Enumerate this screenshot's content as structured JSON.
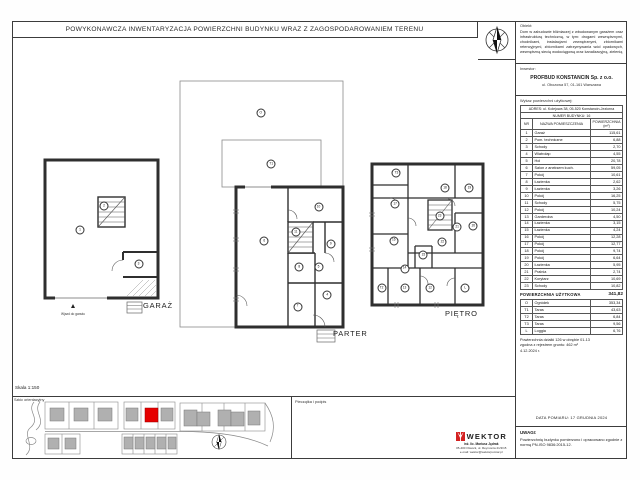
{
  "title": "POWYKONAWCZA INWENTARYZACJA POWIERZCHNI BUDYNKU WRAZ Z ZAGOSPODAROWANIEM TERENU",
  "colors": {
    "accent_red": "#e60000",
    "logo_red": "#d42222"
  },
  "obiekt": {
    "label": "Obiekt:",
    "text": "Dom w zabudowie bliźniaczej z wbudowanym garażem oraz infrastrukturą techniczną, w tym: drogami wewnętrznymi, chodnikami, instalacjami zewnętrznymi, zbiornikami retencyjnymi, zbiornikami zatrzymywania wód opadowych, wewnętrzną siecią wodociągową oraz kanalizacyjną, zielenią"
  },
  "inwestor": {
    "label": "Inwestor:",
    "name": "PROFBUD KONSTANCIN Sp. z o.o.",
    "address": "ul. Obozowa 57, 01-161 Warszawa"
  },
  "wykaz": {
    "label": "Wykaz powierzchni użytkowej:",
    "address_row": "ADRES: ul. Kolejowa 38, 05-520 Konstancin-Jeziorna",
    "building_row": "NUMER BUDYNKU: 16",
    "columns": [
      "NR",
      "NAZWA POMIESZCZENIA",
      "POWIERZCHNIA (m²)"
    ],
    "rows": [
      [
        "1",
        "Garaż",
        "115,61"
      ],
      [
        "2",
        "Pom. techniczne",
        "6,88"
      ],
      [
        "3",
        "Schody",
        "2,70"
      ],
      [
        "4",
        "Wiatrołap",
        "4,55"
      ],
      [
        "5",
        "Hol",
        "20,78"
      ],
      [
        "6",
        "Salon z aneksem kuch.",
        "59,05"
      ],
      [
        "7",
        "Pokój",
        "10,61"
      ],
      [
        "8",
        "Łazienka",
        "2,62"
      ],
      [
        "9",
        "Łazienka",
        "3,26"
      ],
      [
        "10",
        "Pokój",
        "16,25"
      ],
      [
        "11",
        "Schody",
        "5,75"
      ],
      [
        "12",
        "Pokój",
        "10,24"
      ],
      [
        "13",
        "Garderoba",
        "4,50"
      ],
      [
        "14",
        "Łazienka",
        "3,15"
      ],
      [
        "15",
        "Łazienka",
        "4,24"
      ],
      [
        "16",
        "Pokój",
        "12,28"
      ],
      [
        "17",
        "Pokój",
        "12,77"
      ],
      [
        "18",
        "Pokój",
        "9,74"
      ],
      [
        "19",
        "Pokój",
        "6,64"
      ],
      [
        "20",
        "Łazienka",
        "5,95"
      ],
      [
        "21",
        "Pralnia",
        "2,74"
      ],
      [
        "22",
        "Korytarz",
        "10,69"
      ],
      [
        "23",
        "Schody",
        "10,82"
      ]
    ],
    "total_label": "POWIERZCHNIA UŻYTKOWA",
    "total_value": "341,82",
    "extra_rows": [
      [
        "O",
        "Ogródek",
        "353,34"
      ],
      [
        "T1",
        "Taras",
        "43,63"
      ],
      [
        "T2",
        "Taras",
        "6,84"
      ],
      [
        "T3",
        "Taras",
        "9,56"
      ],
      [
        "L",
        "Loggia",
        "6,76"
      ]
    ],
    "note_line1": "Powierzchnia działki 126 w obrębie 01-13",
    "note_line2": "zgodna z rejestrem gruntu: 462 m²",
    "note_line3": "4.12.2024 r.",
    "date_label": "DATA POMIARU: 17 GRUDNIA 2024"
  },
  "uwagi": {
    "label": "UWAGI:",
    "text": "Powierzchnię budynku pomierzono i opracowano zgodnie z normą PN-ISO 9836:2015-12."
  },
  "scale_label": "Skala 1:150",
  "site_sketch_label": "Szkic orientacyjny",
  "stamp_label": "Pieczątka i podpis",
  "logo": {
    "brand": "WEKTOR",
    "line1": "inż. lic. Mariusz Jędrak",
    "line2": "05-400 Otwock, ul. Reymonta 21/3/15",
    "line3": "e-mail: wektor@wektorpomiar.pl"
  },
  "plans": {
    "garaz": {
      "label": "GARAŻ",
      "driveway_label": "Wjazd do garażu",
      "markers": [
        {
          "label": "1",
          "x": 30,
          "y": 51
        },
        {
          "label": "2",
          "x": 46,
          "y": 39
        },
        {
          "label": "3",
          "x": 69,
          "y": 68
        }
      ]
    },
    "parter": {
      "label": "PARTER",
      "markers": [
        {
          "label": "O",
          "x": 49,
          "y": 15
        },
        {
          "label": "T1",
          "x": 55,
          "y": 33
        },
        {
          "label": "6",
          "x": 51,
          "y": 60
        },
        {
          "label": "10",
          "x": 82,
          "y": 48
        },
        {
          "label": "11",
          "x": 69,
          "y": 57
        },
        {
          "label": "9",
          "x": 89,
          "y": 61
        },
        {
          "label": "5",
          "x": 82,
          "y": 69
        },
        {
          "label": "8",
          "x": 71,
          "y": 69
        },
        {
          "label": "7",
          "x": 70,
          "y": 83
        },
        {
          "label": "4",
          "x": 87,
          "y": 79
        }
      ]
    },
    "pietro": {
      "label": "PIĘTRO",
      "markers": [
        {
          "label": "T3",
          "x": 27,
          "y": 9
        },
        {
          "label": "18",
          "x": 63,
          "y": 18
        },
        {
          "label": "19",
          "x": 81,
          "y": 18
        },
        {
          "label": "17",
          "x": 26,
          "y": 28
        },
        {
          "label": "16",
          "x": 25,
          "y": 50
        },
        {
          "label": "23",
          "x": 59,
          "y": 35
        },
        {
          "label": "21",
          "x": 72,
          "y": 42
        },
        {
          "label": "20",
          "x": 84,
          "y": 41
        },
        {
          "label": "22",
          "x": 61,
          "y": 51
        },
        {
          "label": "15",
          "x": 47,
          "y": 59
        },
        {
          "label": "14",
          "x": 33,
          "y": 67
        },
        {
          "label": "13",
          "x": 33,
          "y": 79
        },
        {
          "label": "12",
          "x": 52,
          "y": 79
        },
        {
          "label": "T2",
          "x": 16,
          "y": 79
        },
        {
          "label": "L",
          "x": 78,
          "y": 79
        }
      ]
    }
  }
}
